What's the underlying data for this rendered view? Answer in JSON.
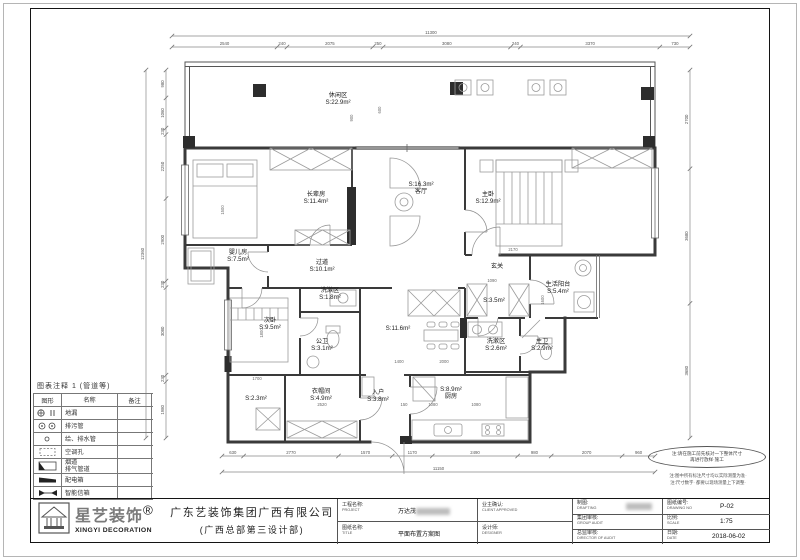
{
  "legend": {
    "title": "图表注释 1 (管道等)",
    "columns": [
      "图形",
      "名称",
      "备注"
    ],
    "rows": [
      {
        "symbol": "floor-drain-icon",
        "name": "地漏",
        "remark": ""
      },
      {
        "symbol": "sewage-pipe-icon",
        "name": "排污管",
        "remark": ""
      },
      {
        "symbol": "water-pipe-icon",
        "name": "给、排水管",
        "remark": ""
      },
      {
        "symbol": "ac-hole-icon",
        "name": "空调孔",
        "remark": ""
      },
      {
        "symbol": "flue-icon",
        "name": "烟道\n排气管道",
        "remark": ""
      },
      {
        "symbol": "power-box-icon",
        "name": "配电箱",
        "remark": ""
      },
      {
        "symbol": "mailbox-icon",
        "name": "智能信箱",
        "remark": ""
      }
    ]
  },
  "notes": {
    "e1": "注:请在施工前先核对一下整体尺寸",
    "e2": "再进行放样·施工",
    "n1": "注:图中所有标注尺寸均以实际测量为准·",
    "n2": "注:尺寸数字· 都要以现场测量上下调整·"
  },
  "title_block": {
    "logo": {
      "brand": "星艺装饰",
      "reg": "®",
      "sub": "XINGYI DECORATION"
    },
    "company_line1": "广东艺装饰集团广西有限公司",
    "company_line2": "(广西总部第三设计部)",
    "fields": {
      "project_label": "工程名称:",
      "project_label_en": "PROJECT",
      "project_value": "万达茂",
      "title_label": "图纸名称:",
      "title_label_en": "TITLE",
      "title_value": "平面布置方案图",
      "client_label": "业主确认:",
      "client_label_en": "CLIENT APPROVED",
      "designer_label": "设计师:",
      "designer_label_en": "DESIGNER",
      "drafting_label": "制图:",
      "drafting_label_en": "DRAFTING",
      "group_audit_label": "集团审核:",
      "group_audit_label_en": "GROUP AUDIT",
      "director_label": "总监审核:",
      "director_label_en": "DIRECTOR OF AUDIT",
      "drawing_no_label": "图纸编号:",
      "drawing_no_label_en": "DRAWING NO",
      "drawing_no": "P-02",
      "scale_label": "比例:",
      "scale_label_en": "SCALE",
      "scale": "1:75",
      "date_label": "日期:",
      "date_label_en": "DATE",
      "date": "2018-06-02"
    }
  },
  "plan": {
    "rooms": [
      {
        "l1": "休闲区",
        "l2": "S:22.9m²",
        "x": 338,
        "y": 97
      },
      {
        "l1": "长辈房",
        "l2": "S:11.4m²",
        "x": 316,
        "y": 196
      },
      {
        "l1": "S:16.3m²",
        "l2": "客厅",
        "x": 421,
        "y": 186
      },
      {
        "l1": "主卧",
        "l2": "S:12.9m²",
        "x": 488,
        "y": 196
      },
      {
        "l1": "婴儿房",
        "l2": "S:7.5m²",
        "x": 238,
        "y": 254
      },
      {
        "l1": "过道",
        "l2": "S:10.1m²",
        "x": 322,
        "y": 264
      },
      {
        "l1": "洗漱区",
        "l2": "S:1.8m²",
        "x": 330,
        "y": 292
      },
      {
        "l1": "次卧",
        "l2": "S:9.5m²",
        "x": 270,
        "y": 322
      },
      {
        "l1": "公卫",
        "l2": "S:3.1m²",
        "x": 322,
        "y": 343
      },
      {
        "l1": "S:2.3m²",
        "l2": "",
        "x": 256,
        "y": 400
      },
      {
        "l1": "衣帽间",
        "l2": "S:4.9m²",
        "x": 321,
        "y": 393
      },
      {
        "l1": "入户",
        "l2": "S:3.8m²",
        "x": 378,
        "y": 394
      },
      {
        "l1": "S:11.6m²",
        "l2": "",
        "x": 398,
        "y": 330
      },
      {
        "l1": "S:8.9m²",
        "l2": "厨房",
        "x": 451,
        "y": 391
      },
      {
        "l1": "玄关",
        "l2": "",
        "x": 497,
        "y": 268
      },
      {
        "l1": "S:3.5m²",
        "l2": "",
        "x": 494,
        "y": 302
      },
      {
        "l1": "生活阳台",
        "l2": "S:5.4m²",
        "x": 558,
        "y": 286
      },
      {
        "l1": "洗漱区",
        "l2": "S:2.6m²",
        "x": 496,
        "y": 343
      },
      {
        "l1": "主卫",
        "l2": "S:2.9m²",
        "x": 542,
        "y": 343
      }
    ]
  },
  "dimensions": {
    "top": {
      "total": "11300",
      "segments": [
        "2540",
        "240",
        "2075",
        "250",
        "3080",
        "240",
        "3370",
        "730"
      ]
    },
    "bottom": {
      "total": "11150",
      "segments": [
        "630",
        "2770",
        "1570",
        "1170",
        "2490",
        "980",
        "2070",
        "960"
      ]
    },
    "left": {
      "total": "12360",
      "segments": [
        "980",
        "1060",
        "230",
        "2250",
        "2900",
        "230",
        "3080",
        "230",
        "1980"
      ]
    },
    "right": {
      "segments": [
        "2700",
        "3680",
        "3680"
      ]
    },
    "interior": [
      {
        "v": "900",
        "x": 353,
        "y": 118,
        "r": -90
      },
      {
        "v": "600",
        "x": 381,
        "y": 110,
        "r": -90
      },
      {
        "v": "2170",
        "x": 513,
        "y": 251,
        "r": 0
      },
      {
        "v": "1090",
        "x": 492,
        "y": 282,
        "r": 0
      },
      {
        "v": "1400",
        "x": 399,
        "y": 363,
        "r": 0
      },
      {
        "v": "2000",
        "x": 444,
        "y": 363,
        "r": 0
      },
      {
        "v": "150",
        "x": 404,
        "y": 406,
        "r": 0
      },
      {
        "v": "1080",
        "x": 433,
        "y": 406,
        "r": 0
      },
      {
        "v": "1080",
        "x": 476,
        "y": 406,
        "r": 0
      },
      {
        "v": "2520",
        "x": 322,
        "y": 406,
        "r": 0
      },
      {
        "v": "1700",
        "x": 257,
        "y": 380,
        "r": 0
      },
      {
        "v": "1800",
        "x": 263,
        "y": 333,
        "r": -90
      },
      {
        "v": "1500",
        "x": 224,
        "y": 210,
        "r": -90
      },
      {
        "v": "1600",
        "x": 544,
        "y": 300,
        "r": -90
      }
    ]
  }
}
